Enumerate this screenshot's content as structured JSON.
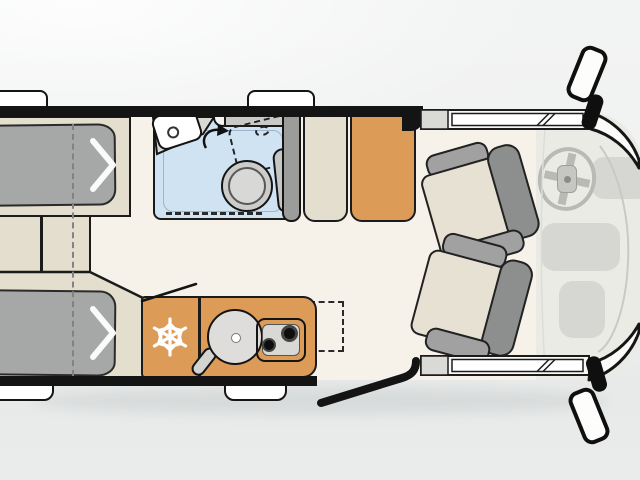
{
  "colors": {
    "background": "#f0f1f1",
    "floor_cream": "#f7f2e9",
    "cab_floor": "#ebebe6",
    "furniture_beige": "#e3decd",
    "mattress_gray": "#a6a8a7",
    "kitchen_orange": "#dc9c57",
    "bathroom_blue": "#cfe3f2",
    "outline_dark": "#1b1b1b",
    "fixture_gray": "#c9c9c7",
    "fixture_light": "#d8d8d5",
    "seat_cushion": "#e7e1d4",
    "seat_gray": "#a0a1a0",
    "seat_back_gray": "#8d8f8f",
    "dash_gray": "#d6d6d2",
    "wheel_gray": "#b9b9b6",
    "white": "#ffffff",
    "wall_black": "#141414"
  },
  "floorplan": {
    "type": "campervan-top-view",
    "zones": [
      {
        "name": "rear-beds",
        "items": [
          "bed-top",
          "bed-bottom",
          "mid-cabinet",
          "fold-line-dashed",
          "fold-arrow-top",
          "fold-arrow-bottom"
        ]
      },
      {
        "name": "bathroom",
        "items": [
          "shower-floor",
          "shower-tray",
          "shower-curtain-dashed",
          "washbasin",
          "tap-dot",
          "swivel-arrow",
          "counter-shelf",
          "swivel-toilet",
          "toilet-dashed-position",
          "wall-pillar"
        ]
      },
      {
        "name": "storage",
        "items": [
          "side-cabinet",
          "wardrobe"
        ]
      },
      {
        "name": "kitchen",
        "items": [
          "fridge-snowflake",
          "round-sink",
          "faucet",
          "two-burner-stove",
          "fold-out-counter-dashed",
          "towel-bar"
        ]
      },
      {
        "name": "cab",
        "items": [
          "driver-swivel-seat",
          "passenger-swivel-seat",
          "steering-wheel",
          "dashboard-right",
          "dashboard-center",
          "dashboard-lower",
          "windshield-top",
          "windshield-bottom",
          "cab-window-strip-top",
          "cab-window-strip-bottom",
          "mirror-top",
          "mirror-bottom"
        ]
      },
      {
        "name": "entry",
        "items": [
          "sliding-door-open",
          "window-tab-top-rear",
          "window-tab-top-mid",
          "window-tab-bottom-rear",
          "window-tab-bottom-mid"
        ]
      }
    ],
    "icons": {
      "fridge": "snowflake-icon",
      "bed_fold": "chevron-arrow-icon",
      "toilet_swivel": "curved-arrow-icon"
    }
  }
}
